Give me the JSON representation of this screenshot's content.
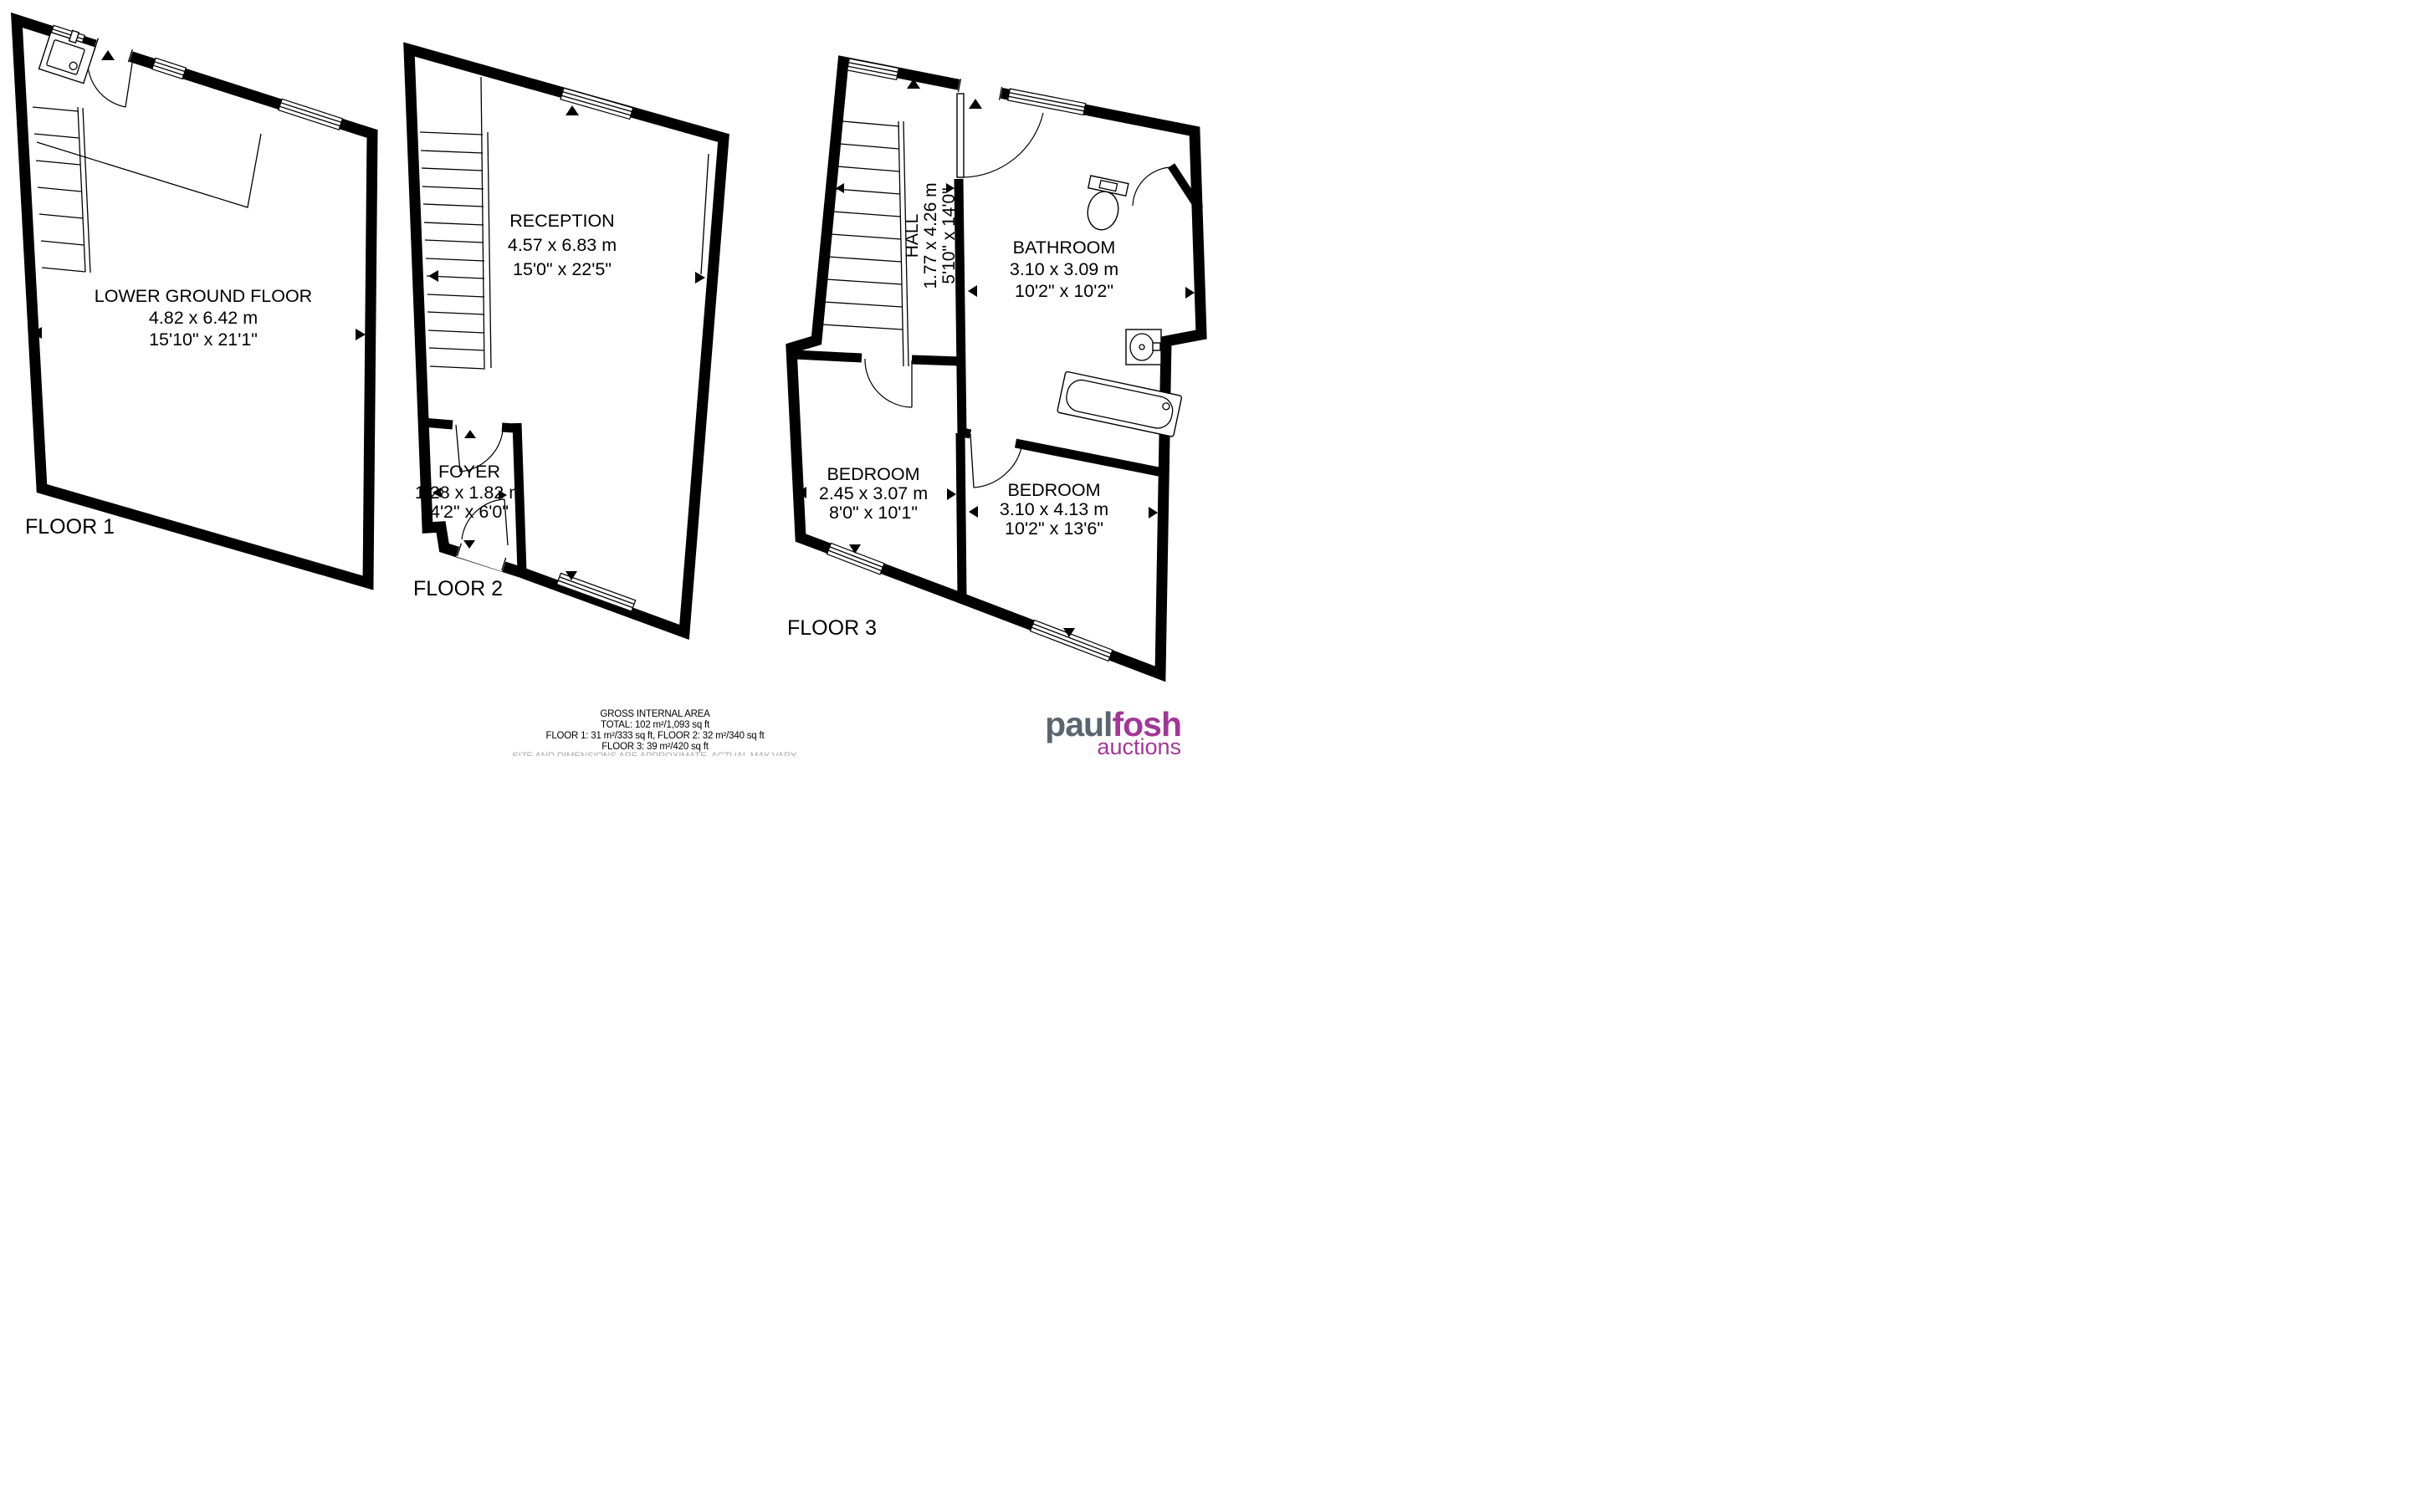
{
  "floors": [
    {
      "label": "FLOOR 1",
      "rooms": [
        {
          "name": "LOWER GROUND FLOOR",
          "metric": "4.82 x 6.42 m",
          "imperial": "15'10\" x 21'1\""
        }
      ]
    },
    {
      "label": "FLOOR 2",
      "rooms": [
        {
          "name": "RECEPTION",
          "metric": "4.57 x 6.83 m",
          "imperial": "15'0\" x 22'5\""
        },
        {
          "name": "FOYER",
          "metric": "1.28 x 1.82 m",
          "imperial": "4'2\" x 6'0\""
        }
      ]
    },
    {
      "label": "FLOOR 3",
      "rooms": [
        {
          "name": "HALL",
          "metric": "1.77 x 4.26 m",
          "imperial": "5'10\" x 14'0\""
        },
        {
          "name": "BATHROOM",
          "metric": "3.10 x 3.09 m",
          "imperial": "10'2\" x 10'2\""
        },
        {
          "name": "BEDROOM",
          "metric": "2.45 x 3.07 m",
          "imperial": "8'0\" x 10'1\""
        },
        {
          "name": "BEDROOM",
          "metric": "3.10 x 4.13 m",
          "imperial": "10'2\" x 13'6\""
        }
      ]
    }
  ],
  "footer": {
    "title": "GROSS INTERNAL AREA",
    "total": "TOTAL: 102 m²/1,093 sq ft",
    "floors_1_2": "FLOOR 1: 31 m²/333 sq ft, FLOOR 2: 32 m²/340 sq ft",
    "floor_3": "FLOOR 3: 39 m²/420 sq ft",
    "disclaimer": "SIZE AND DIMENSIONS ARE APPROXIMATE, ACTUAL MAY VARY."
  },
  "logo": {
    "word1": "paul",
    "word2": "fosh",
    "word3": "auctions",
    "color_gray": "#5b6570",
    "color_purple": "#a13896"
  },
  "colors": {
    "wall": "#000000",
    "background": "#ffffff",
    "disclaimer_gray": "#ababab"
  }
}
